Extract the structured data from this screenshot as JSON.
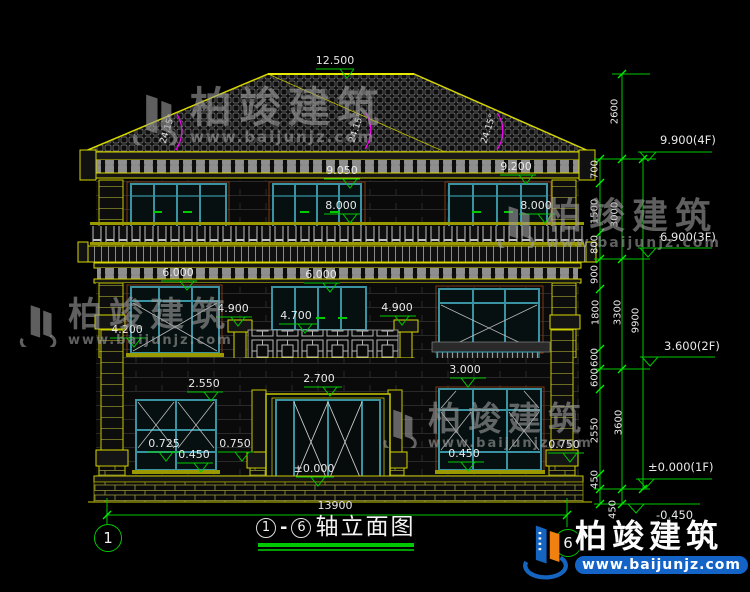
{
  "watermark": {
    "brand": "柏竣建筑",
    "url": "www.baijunjz.com"
  },
  "title": {
    "axis_from": "1",
    "dash": "-",
    "axis_to": "6",
    "text": "轴立面图"
  },
  "axis_bubbles": {
    "left": "1",
    "right": "6"
  },
  "roof": {
    "ridge_elev": "12.500",
    "angle": "24.15°"
  },
  "overall_width": "13900",
  "elevations": {
    "e9050": "9.050",
    "e9200": "9.200",
    "e8000": "8.000",
    "e6000": "6.000",
    "e4900": "4.900",
    "e4700": "4.700",
    "e4200": "4.200",
    "e3000": "3.000",
    "e2700": "2.700",
    "e2550": "2.550",
    "e0725": "0.725",
    "e0750": "0.750",
    "e0450": "0.450",
    "e0000": "±0.000"
  },
  "floor_marks": {
    "f4": "9.900(4F)",
    "f3": "6.900(3F)",
    "f2": "3.600(2F)",
    "f1": "±0.000(1F)",
    "ground": "-0.450"
  },
  "dim_chain": {
    "segments": [
      "2600",
      "700",
      "1500",
      "800",
      "900",
      "1800",
      "600",
      "600",
      "2550",
      "450",
      "450"
    ],
    "groups": [
      "3000",
      "3300",
      "3600"
    ],
    "total": "9900"
  },
  "colors": {
    "dimension_green": "#00c800",
    "line_yellow": "#cdcd00",
    "frame_teal": "#3a93a3",
    "angle_magenta": "#ff00ff",
    "logo_blue": "#1565c0",
    "logo_orange": "#f08010"
  }
}
